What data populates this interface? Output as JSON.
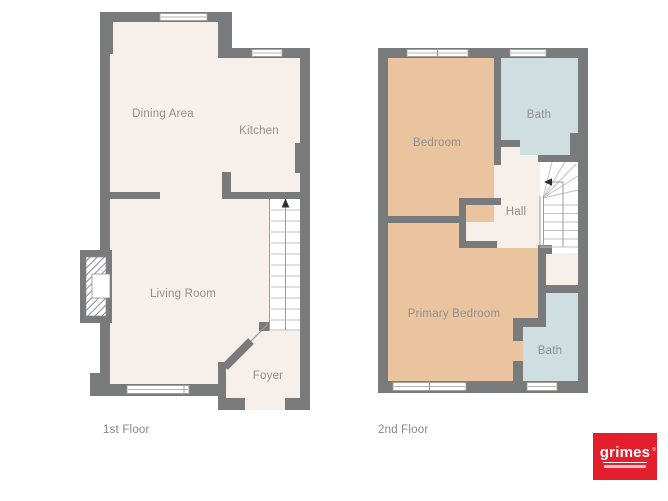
{
  "floor_plans": [
    {
      "caption": "1st Floor",
      "rooms": [
        {
          "label": "Dining Area"
        },
        {
          "label": "Kitchen"
        },
        {
          "label": "Living Room"
        },
        {
          "label": "Foyer"
        }
      ],
      "features": [
        "staircase with up arrow",
        "fireplace",
        "windows",
        "front door opening"
      ]
    },
    {
      "caption": "2nd Floor",
      "rooms": [
        {
          "label": "Bedroom"
        },
        {
          "label": "Bath"
        },
        {
          "label": "Hall"
        },
        {
          "label": "Primary Bedroom"
        },
        {
          "label": "Bath"
        }
      ],
      "features": [
        "winder staircase with arrow",
        "closet alcove",
        "windows"
      ]
    }
  ],
  "logo": {
    "brand": "grimes",
    "registered_mark": "®"
  },
  "colors": {
    "wall": "#797a7c",
    "floor_cream": "#f7f0ea",
    "bedroom_tan": "#eac49e",
    "bath_blue": "#cfdfe1",
    "stair_tread_line": "#c2c2c2",
    "label_text": "#8f8f8f",
    "logo_red": "#e41e2d"
  }
}
